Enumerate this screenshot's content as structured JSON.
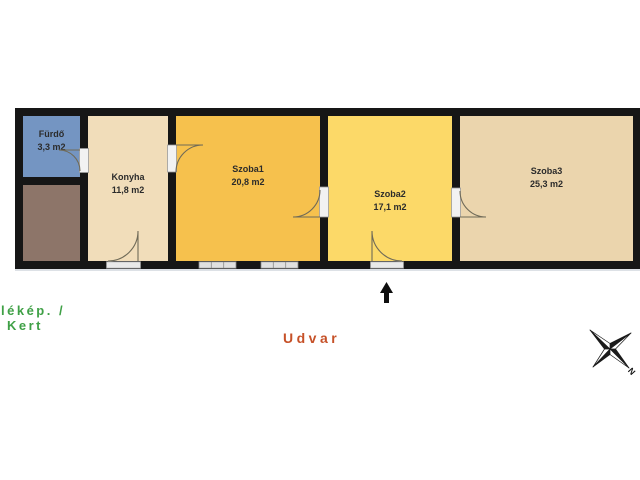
{
  "floorplan": {
    "wall_color": "#161616",
    "rooms": [
      {
        "name": "Fürdő",
        "area": "3,3 m2",
        "color": "#7495c2"
      },
      {
        "color": "#8d7569"
      },
      {
        "name": "Konyha",
        "area": "11,8 m2",
        "color": "#f1ddba"
      },
      {
        "name": "Szoba1",
        "area": "20,8 m2",
        "color": "#f6c14d"
      },
      {
        "name": "Szoba2",
        "area": "17,1 m2",
        "color": "#fcd968"
      },
      {
        "name": "Szoba3",
        "area": "25,3 m2",
        "color": "#ebd5ad"
      }
    ]
  },
  "labels": {
    "garden_line1": "lékép. /",
    "garden_line2": "Kert",
    "garden_color": "#3fa046",
    "courtyard": "Udvar",
    "courtyard_color": "#c65128",
    "compass_north": "N"
  }
}
